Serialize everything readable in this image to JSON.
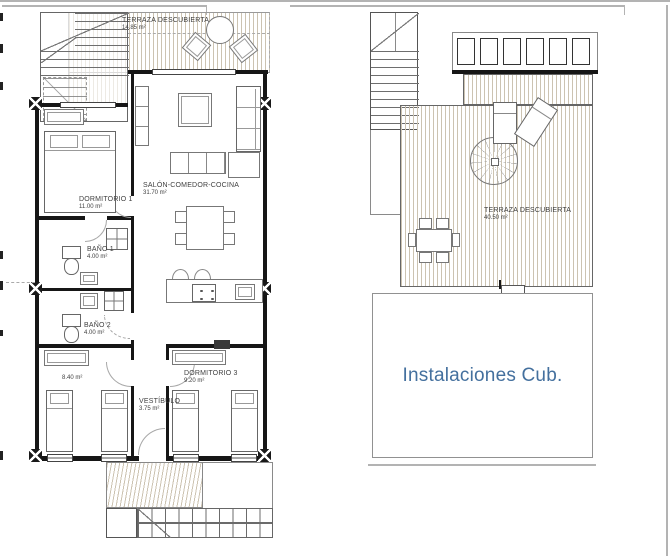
{
  "left_plan": {
    "terrace": {
      "name": "TERRAZA DESCUBIERTA",
      "area": "14.85 m²"
    },
    "living": {
      "name": "SALÓN-COMEDOR-COCINA",
      "area": "31.70 m²"
    },
    "bedroom1": {
      "name": "DORMITORIO 1",
      "area": "11.00 m²"
    },
    "bath1": {
      "name": "BAÑO 1",
      "area": "4.00 m²"
    },
    "bath2": {
      "name": "BAÑO 2",
      "area": "4.00 m²"
    },
    "bedroom2": {
      "area": "8.40 m²"
    },
    "hall": {
      "name": "VESTÍBULO",
      "area": "3.75 m²"
    },
    "bedroom3": {
      "name": "DORMITORIO 3",
      "area": "9.20 m²"
    }
  },
  "right_plan": {
    "terrace": {
      "name": "TERRAZA DESCUBIERTA",
      "area": "40.50 m²"
    },
    "installations": {
      "label": "Instalaciones Cub."
    }
  },
  "colors": {
    "deck_stripe": "#ccc3b1",
    "accent_blue": "#44709e",
    "wall": "#161616"
  }
}
